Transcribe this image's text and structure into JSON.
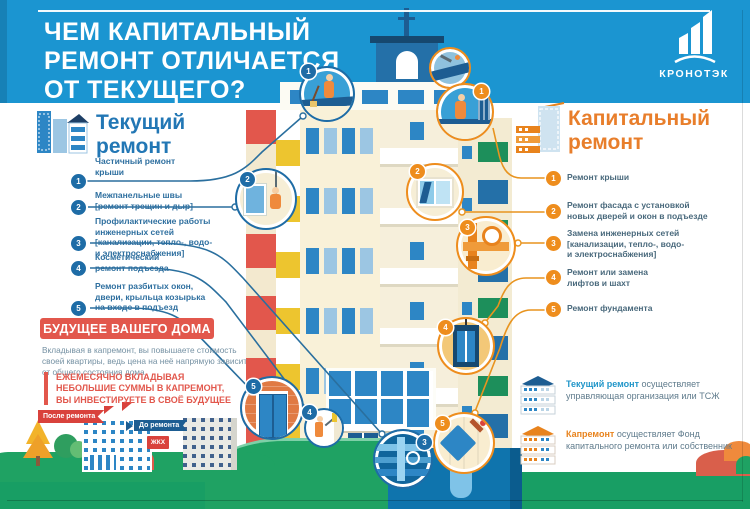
{
  "title": "ЧЕМ КАПИТАЛЬНЫЙ\nРЕМОНТ ОТЛИЧАЕТСЯ\nОТ ТЕКУЩЕГО?",
  "logo": {
    "name": "КРОНОТЭК"
  },
  "current_repair": {
    "heading": "Текущий\nремонт",
    "items": [
      {
        "n": "1",
        "text": "Частичный ремонт\nкрыши"
      },
      {
        "n": "2",
        "text": "Межпанельные швы\n[ремонт трещин и дыр]"
      },
      {
        "n": "3",
        "text": "Профилактические работы\nинженерных сетей\n[канализации, тепло-, водо-\nи электроснабжения]"
      },
      {
        "n": "4",
        "text": "Косметический\nремонт подъезда"
      },
      {
        "n": "5",
        "text": "Ремонт разбитых окон,\nдвери, крыльца козырька\nна входе в подъезд"
      }
    ]
  },
  "capital_repair": {
    "heading": "Капитальный\nремонт",
    "items": [
      {
        "n": "1",
        "text": "Ремонт крыши"
      },
      {
        "n": "2",
        "text": "Ремонт фасада с установкой\nновых дверей и окон в подъезде"
      },
      {
        "n": "3",
        "text": "Замена инженерных сетей\n[канализации, тепло-, водо-\nи электроснабжения]"
      },
      {
        "n": "4",
        "text": "Ремонт или замена\nлифтов и шахт"
      },
      {
        "n": "5",
        "text": "Ремонт фундамента"
      }
    ]
  },
  "future_banner": {
    "title": "БУДУЩЕЕ ВАШЕГО ДОМА",
    "text": "Вкладывая в капремонт, вы повышаете стоимость\nсвоей квартиры, ведь цена на неё напрямую зависит\nот общего состояния дома",
    "highlight": "ЕЖЕМЕСЯЧНО ВКЛАДЫВАЯ\nНЕБОЛЬШИЕ СУММЫ В КАПРЕМОНТ,\nВЫ ИНВЕСТИРУЕТЕ В СВОЁ БУДУЩЕЕ"
  },
  "before_after": {
    "after_label": "После ремонта",
    "before_label": "До ремонта",
    "sign": "ЖКХ"
  },
  "legend": [
    {
      "highlight": "Текущий ремонт",
      "rest": "осуществляет управляющая организация или ТСЖ"
    },
    {
      "highlight": "Капремонт",
      "rest": "осуществляет Фонд капитального ремонта или собственник"
    }
  ],
  "colors": {
    "sky": "#1b95d1",
    "accent_blue": "#2277b5",
    "accent_orange": "#e8831d",
    "red": "#e2574c",
    "green": "#189e64"
  }
}
